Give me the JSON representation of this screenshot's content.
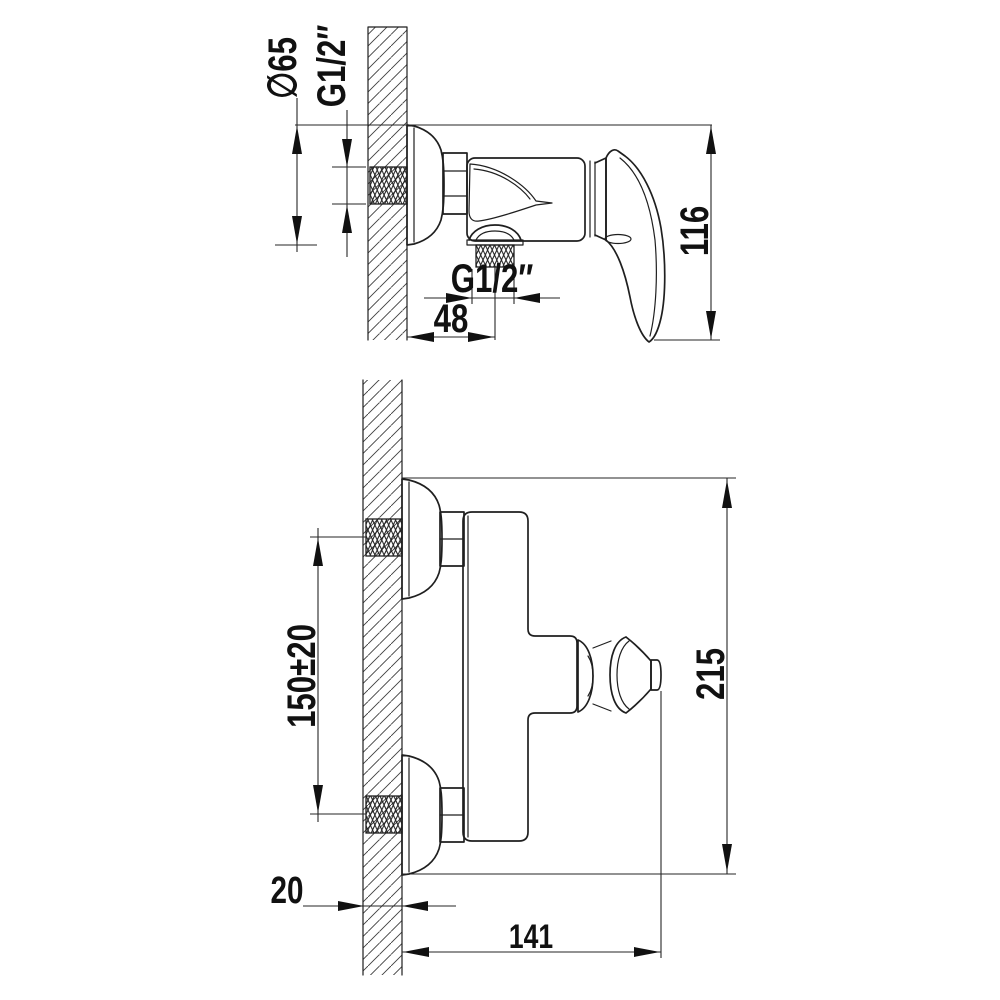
{
  "drawing": {
    "title": "Wall-mounted shower mixer installation drawing",
    "colors": {
      "line": "#1f1f1f",
      "background": "#ffffff"
    },
    "top_view": {
      "flange_diameter": "∅65",
      "inlet_thread": "G1/2″",
      "height": "116",
      "outlet_thread": "G1/2″",
      "outlet_offset": "48"
    },
    "front_view": {
      "inlet_spacing": "150±20",
      "overall_height": "215",
      "wall_thickness": "20",
      "overall_width": "141"
    }
  }
}
